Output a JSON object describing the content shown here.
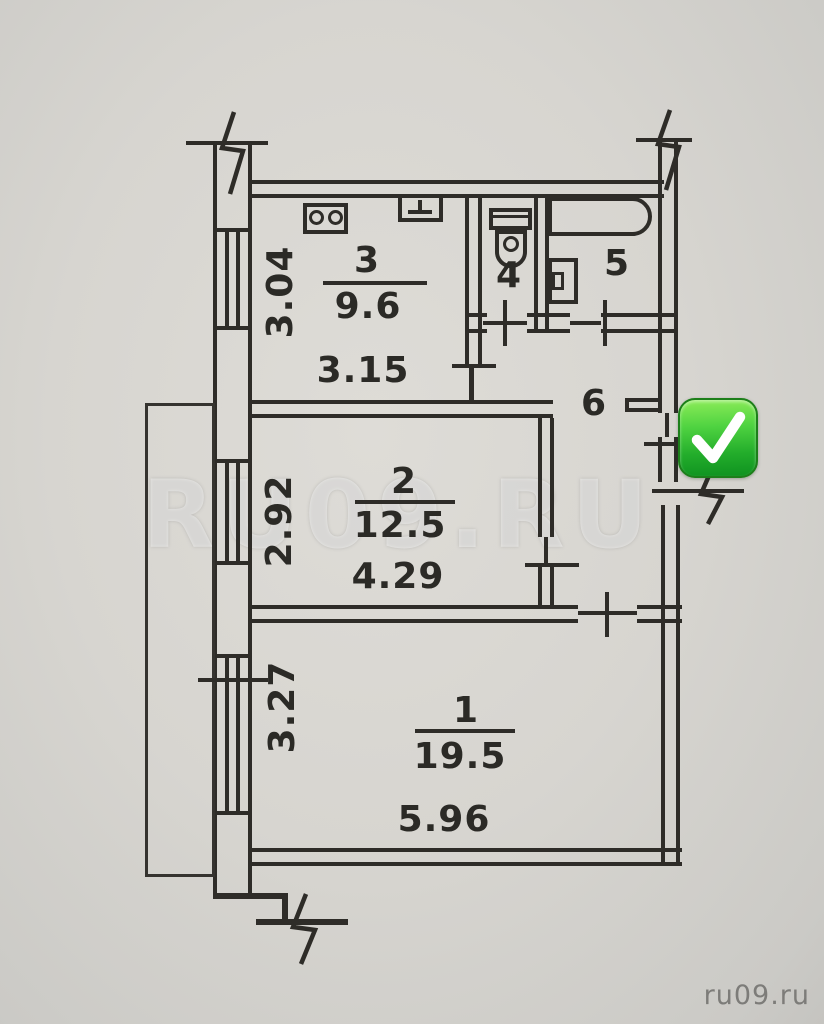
{
  "plan": {
    "title": "apartment-floor-plan",
    "rooms": [
      {
        "id": "room-1",
        "number": "1",
        "area": "19.5",
        "width": "5.96",
        "depth": "3.27"
      },
      {
        "id": "room-2",
        "number": "2",
        "area": "12.5",
        "width": "4.29",
        "depth": "2.92"
      },
      {
        "id": "room-3",
        "number": "3",
        "area": "9.6",
        "width": "3.15",
        "depth": "3.04"
      },
      {
        "id": "room-4-wc",
        "number": "4"
      },
      {
        "id": "room-5-bath",
        "number": "5"
      },
      {
        "id": "room-6-hall",
        "number": "6"
      }
    ],
    "fixtures": [
      "stove-icon",
      "kitchen-sink-icon",
      "toilet-icon",
      "bathtub-icon",
      "washbasin-icon"
    ],
    "symbols": [
      "window-symbol",
      "door-opening",
      "wall-break-symbol",
      "balcony-outline",
      "approved-check-icon"
    ],
    "colors": {
      "ink": "#2e2c28",
      "paper": "#d7d5d0",
      "check_green": "#2eb52e"
    }
  },
  "watermark": {
    "text": "RU09.RU"
  },
  "footer": {
    "site": "ru09.ru"
  }
}
